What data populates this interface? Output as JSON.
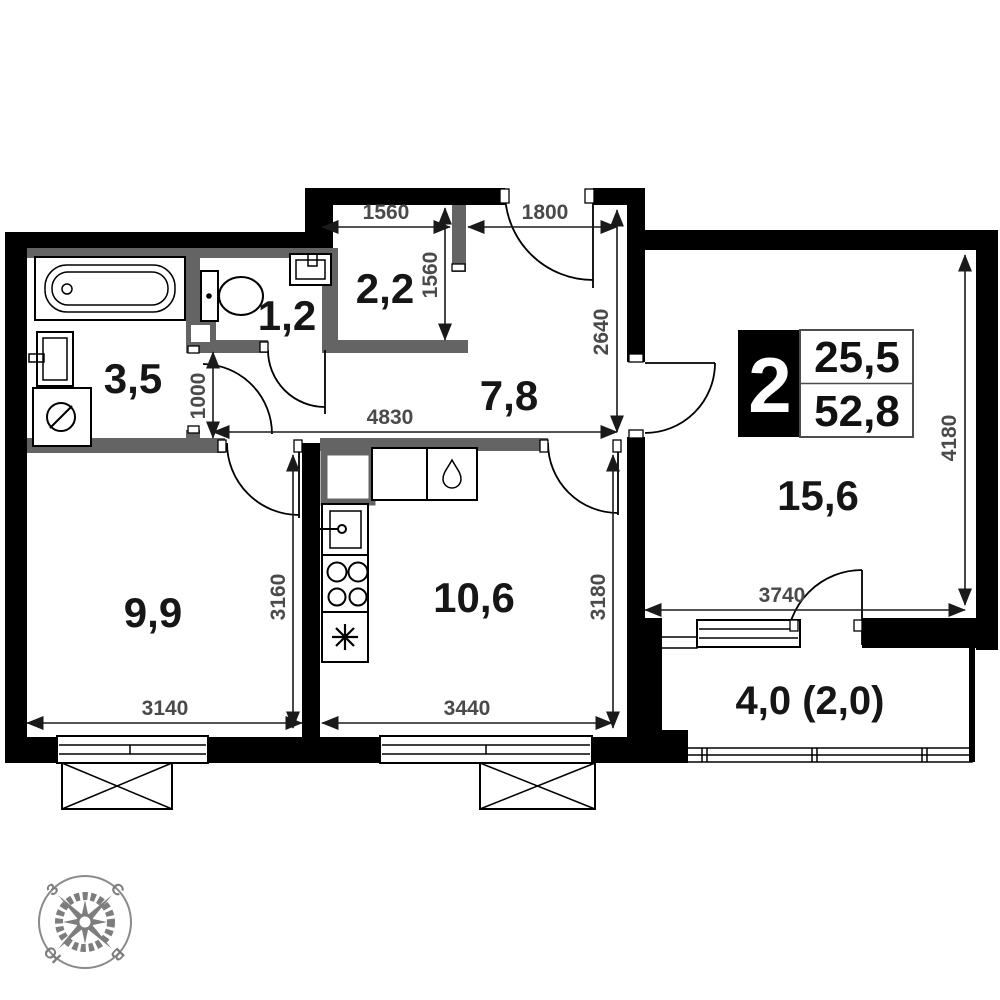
{
  "rooms": [
    {
      "name": "bathroom",
      "area": "3,5"
    },
    {
      "name": "toilet",
      "area": "1,2"
    },
    {
      "name": "wardrobe",
      "area": "2,2"
    },
    {
      "name": "hallway",
      "area": "7,8"
    },
    {
      "name": "bedroom",
      "area": "9,9"
    },
    {
      "name": "kitchen",
      "area": "10,6"
    },
    {
      "name": "living-room",
      "area": "15,6"
    },
    {
      "name": "balcony",
      "area": "4,0 (2,0)"
    }
  ],
  "dims": {
    "entry_left": "1560",
    "entry_right": "1800",
    "wardrobe_depth": "1560",
    "hall_depth": "2640",
    "hall_width": "4830",
    "bath_door": "1000",
    "bedroom_width": "3140",
    "bedroom_depth": "3160",
    "kitchen_width": "3440",
    "kitchen_depth": "3180",
    "living_width": "3740",
    "living_depth": "4180"
  },
  "badge": {
    "rooms_count": "2",
    "area_living": "25,5",
    "area_total": "52,8"
  },
  "compass": {
    "west": "З",
    "north": "С",
    "south": "Ю",
    "east": "В"
  },
  "colors": {
    "wall": "#000000",
    "partition": "#646464",
    "dim_text": "#4a4a4a",
    "compass": "#7d7d7d"
  }
}
